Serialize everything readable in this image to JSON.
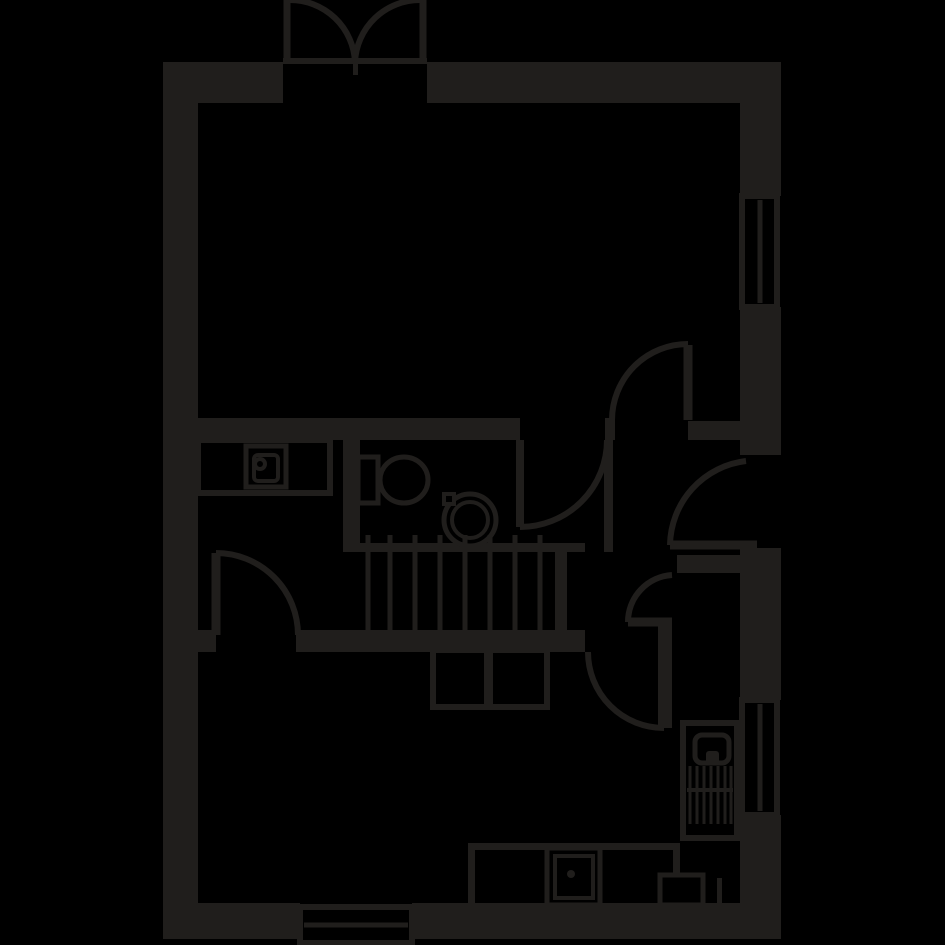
{
  "canvas": {
    "width": 945,
    "height": 945,
    "background": "#000000",
    "line_color": "#201E1C"
  },
  "plan": {
    "name": "house-ground-floor-plan",
    "strip": {
      "x": 163,
      "width": 618
    },
    "shapes": [
      {
        "name": "wall-left",
        "type": "rect",
        "x": 163,
        "y": 62,
        "w": 35,
        "h": 876
      },
      {
        "name": "wall-top-left",
        "type": "rect",
        "x": 163,
        "y": 62,
        "w": 120,
        "h": 41
      },
      {
        "name": "wall-top-right",
        "type": "rect",
        "x": 427,
        "y": 62,
        "w": 313,
        "h": 41
      },
      {
        "name": "wall-right-top",
        "type": "rect",
        "x": 740,
        "y": 62,
        "w": 41,
        "h": 134
      },
      {
        "name": "wall-right-mid",
        "type": "rect",
        "x": 740,
        "y": 307,
        "w": 41,
        "h": 148
      },
      {
        "name": "wall-right-lower",
        "type": "rect",
        "x": 740,
        "y": 548,
        "w": 41,
        "h": 152
      },
      {
        "name": "wall-right-bottom",
        "type": "rect",
        "x": 740,
        "y": 815,
        "w": 41,
        "h": 123
      },
      {
        "name": "wall-bottom-left",
        "type": "rect",
        "x": 163,
        "y": 903,
        "w": 137,
        "h": 36
      },
      {
        "name": "wall-bottom-right",
        "type": "rect",
        "x": 412,
        "y": 903,
        "w": 369,
        "h": 36
      },
      {
        "name": "wall-middle-left",
        "type": "rect",
        "x": 163,
        "y": 418,
        "w": 357,
        "h": 22
      },
      {
        "name": "wall-middle-jamb",
        "type": "rect",
        "x": 605,
        "y": 418,
        "w": 10,
        "h": 22
      },
      {
        "name": "wall-middle-right",
        "type": "rect",
        "x": 688,
        "y": 421,
        "w": 52,
        "h": 19
      },
      {
        "name": "wall-kitchen-wc",
        "type": "rect",
        "x": 343,
        "y": 418,
        "w": 17,
        "h": 134
      },
      {
        "name": "wall-wc-hall-stub",
        "type": "rect",
        "x": 604,
        "y": 440,
        "w": 9,
        "h": 112
      },
      {
        "name": "wall-stairs-top",
        "type": "rect",
        "x": 357,
        "y": 543,
        "w": 228,
        "h": 9
      },
      {
        "name": "stairs-right-edge",
        "type": "rect",
        "x": 555,
        "y": 543,
        "w": 12,
        "h": 90
      },
      {
        "name": "wall-under-stairs",
        "type": "rect",
        "x": 296,
        "y": 630,
        "w": 289,
        "h": 22
      },
      {
        "name": "wall-left-pier",
        "type": "rect",
        "x": 163,
        "y": 630,
        "w": 53,
        "h": 22
      },
      {
        "name": "wall-hall-southeast",
        "type": "rect",
        "x": 677,
        "y": 555,
        "w": 63,
        "h": 18
      },
      {
        "name": "wall-cupboard-bar",
        "type": "rect",
        "x": 658,
        "y": 622,
        "w": 14,
        "h": 106
      },
      {
        "name": "french-door-threshold",
        "type": "rect",
        "x": 283,
        "y": 58,
        "w": 144,
        "h": 6
      },
      {
        "name": "french-door-center-tick",
        "type": "rect",
        "x": 353,
        "y": 58,
        "w": 5,
        "h": 17
      },
      {
        "name": "window-right-top",
        "type": "orect",
        "x": 742,
        "y": 196,
        "w": 35,
        "h": 111,
        "sw": 6
      },
      {
        "name": "window-right-top-mullion",
        "type": "line",
        "x1": 760,
        "y1": 200,
        "x2": 760,
        "y2": 303,
        "sw": 5
      },
      {
        "name": "window-right-bottom",
        "type": "orect",
        "x": 742,
        "y": 700,
        "w": 35,
        "h": 115,
        "sw": 6
      },
      {
        "name": "window-right-bottom-mullion",
        "type": "line",
        "x1": 760,
        "y1": 704,
        "x2": 760,
        "y2": 811,
        "sw": 5
      },
      {
        "name": "window-bottom",
        "type": "orect",
        "x": 300,
        "y": 907,
        "w": 112,
        "h": 36,
        "sw": 6
      },
      {
        "name": "window-bottom-mullion",
        "type": "line",
        "x1": 304,
        "y1": 925,
        "x2": 408,
        "y2": 925,
        "sw": 5
      },
      {
        "name": "french-door-left-leaf",
        "type": "line",
        "x1": 287,
        "y1": 0,
        "x2": 287,
        "y2": 62,
        "sw": 7
      },
      {
        "name": "french-door-left-swing",
        "type": "path",
        "d": "M 355 62 A 65 65 0 0 0 290 0",
        "sw": 6
      },
      {
        "name": "french-door-right-leaf",
        "type": "line",
        "x1": 423,
        "y1": 0,
        "x2": 423,
        "y2": 62,
        "sw": 7
      },
      {
        "name": "french-door-right-swing",
        "type": "path",
        "d": "M 355 62 A 65 65 0 0 1 420 0",
        "sw": 6
      },
      {
        "name": "living-door-leaf",
        "type": "line",
        "x1": 688,
        "y1": 345,
        "x2": 688,
        "y2": 420,
        "sw": 9
      },
      {
        "name": "living-door-swing",
        "type": "path",
        "d": "M 612 420 A 76 76 0 0 1 688 344",
        "sw": 6
      },
      {
        "name": "wc-door-leaf",
        "type": "line",
        "x1": 520,
        "y1": 440,
        "x2": 520,
        "y2": 527,
        "sw": 8
      },
      {
        "name": "wc-door-swing",
        "type": "path",
        "d": "M 607 440 A 87 87 0 0 1 520 527",
        "sw": 6
      },
      {
        "name": "front-door-leaf",
        "type": "line",
        "x1": 670,
        "y1": 545,
        "x2": 757,
        "y2": 545,
        "sw": 9
      },
      {
        "name": "front-door-swing",
        "type": "path",
        "d": "M 746 461 A 86 86 0 0 0 670 545",
        "sw": 6
      },
      {
        "name": "dining-door-swing",
        "type": "path",
        "d": "M 588 652 A 76 76 0 0 0 664 728",
        "sw": 6
      },
      {
        "name": "kitchen-door-leaf",
        "type": "line",
        "x1": 216,
        "y1": 553,
        "x2": 216,
        "y2": 635,
        "sw": 9
      },
      {
        "name": "kitchen-door-swing",
        "type": "path",
        "d": "M 216 553 A 82 82 0 0 1 298 635",
        "sw": 6
      },
      {
        "name": "cupboard-door-leaf",
        "type": "line",
        "x1": 628,
        "y1": 622,
        "x2": 672,
        "y2": 622,
        "sw": 9
      },
      {
        "name": "cupboard-door-swing",
        "type": "path",
        "d": "M 672 575 A 47 47 0 0 0 628 622",
        "sw": 6
      },
      {
        "name": "kitchen-counter",
        "type": "orect",
        "x": 198,
        "y": 440,
        "w": 132,
        "h": 53,
        "sw": 6
      },
      {
        "name": "kitchen-sink",
        "type": "orect",
        "x": 246,
        "y": 446,
        "w": 40,
        "h": 41,
        "sw": 5
      },
      {
        "name": "kitchen-sink-bowl",
        "type": "orect",
        "x": 254,
        "y": 455,
        "w": 24,
        "h": 26,
        "sw": 4,
        "rx": 4
      },
      {
        "name": "kitchen-tap",
        "type": "circle",
        "cx": 260,
        "cy": 464,
        "r": 5,
        "sw": 4
      },
      {
        "name": "toilet-cistern",
        "type": "orect",
        "x": 358,
        "y": 457,
        "w": 20,
        "h": 46,
        "sw": 5
      },
      {
        "name": "toilet-bowl",
        "type": "ellipse",
        "cx": 404,
        "cy": 480,
        "rx": 24,
        "ry": 23,
        "sw": 5
      },
      {
        "name": "basin-outer",
        "type": "circle",
        "cx": 470,
        "cy": 520,
        "r": 26,
        "sw": 5
      },
      {
        "name": "basin-inner",
        "type": "circle",
        "cx": 470,
        "cy": 520,
        "r": 18,
        "sw": 4
      },
      {
        "name": "basin-tap",
        "type": "orect",
        "x": 444,
        "y": 494,
        "w": 10,
        "h": 10,
        "sw": 4
      },
      {
        "name": "stair-tread-1",
        "type": "line",
        "x1": 368,
        "y1": 535,
        "x2": 368,
        "y2": 630,
        "sw": 5
      },
      {
        "name": "stair-tread-2",
        "type": "line",
        "x1": 390,
        "y1": 535,
        "x2": 390,
        "y2": 630,
        "sw": 5
      },
      {
        "name": "stair-tread-3",
        "type": "line",
        "x1": 415,
        "y1": 535,
        "x2": 415,
        "y2": 630,
        "sw": 5
      },
      {
        "name": "stair-tread-4",
        "type": "line",
        "x1": 440,
        "y1": 535,
        "x2": 440,
        "y2": 630,
        "sw": 5
      },
      {
        "name": "stair-tread-5",
        "type": "line",
        "x1": 465,
        "y1": 535,
        "x2": 465,
        "y2": 630,
        "sw": 5
      },
      {
        "name": "stair-tread-6",
        "type": "line",
        "x1": 490,
        "y1": 535,
        "x2": 490,
        "y2": 630,
        "sw": 5
      },
      {
        "name": "stair-tread-7",
        "type": "line",
        "x1": 515,
        "y1": 535,
        "x2": 515,
        "y2": 630,
        "sw": 5
      },
      {
        "name": "stair-tread-8",
        "type": "line",
        "x1": 540,
        "y1": 535,
        "x2": 540,
        "y2": 630,
        "sw": 5
      },
      {
        "name": "understair-cupboard-1",
        "type": "orect",
        "x": 433,
        "y": 650,
        "w": 54,
        "h": 57,
        "sw": 6
      },
      {
        "name": "understair-cupboard-2",
        "type": "orect",
        "x": 490,
        "y": 650,
        "w": 57,
        "h": 57,
        "sw": 6
      },
      {
        "name": "larder-unit",
        "type": "orect",
        "x": 683,
        "y": 723,
        "w": 54,
        "h": 115,
        "sw": 6
      },
      {
        "name": "larder-window",
        "type": "orect",
        "x": 695,
        "y": 735,
        "w": 34,
        "h": 28,
        "sw": 5,
        "rx": 7
      },
      {
        "name": "larder-knob",
        "type": "frect",
        "x": 706,
        "y": 751,
        "w": 13,
        "h": 13,
        "rx": 3
      },
      {
        "name": "larder-grille-h",
        "type": "line",
        "x1": 687,
        "y1": 790,
        "x2": 733,
        "y2": 790,
        "sw": 4
      },
      {
        "name": "larder-grille-1",
        "type": "line",
        "x1": 690,
        "y1": 766,
        "x2": 690,
        "y2": 824,
        "sw": 3
      },
      {
        "name": "larder-grille-2",
        "type": "line",
        "x1": 697,
        "y1": 766,
        "x2": 697,
        "y2": 824,
        "sw": 3
      },
      {
        "name": "larder-grille-3",
        "type": "line",
        "x1": 704,
        "y1": 766,
        "x2": 704,
        "y2": 824,
        "sw": 3
      },
      {
        "name": "larder-grille-4",
        "type": "line",
        "x1": 711,
        "y1": 766,
        "x2": 711,
        "y2": 824,
        "sw": 3
      },
      {
        "name": "larder-grille-5",
        "type": "line",
        "x1": 718,
        "y1": 766,
        "x2": 718,
        "y2": 824,
        "sw": 3
      },
      {
        "name": "larder-grille-6",
        "type": "line",
        "x1": 725,
        "y1": 766,
        "x2": 725,
        "y2": 824,
        "sw": 3
      },
      {
        "name": "larder-grille-7",
        "type": "line",
        "x1": 731,
        "y1": 766,
        "x2": 731,
        "y2": 824,
        "sw": 3
      },
      {
        "name": "base-counter-top",
        "type": "frect",
        "x": 468,
        "y": 843,
        "w": 212,
        "h": 7
      },
      {
        "name": "base-counter-left",
        "type": "frect",
        "x": 468,
        "y": 843,
        "w": 7,
        "h": 62
      },
      {
        "name": "base-counter-right",
        "type": "frect",
        "x": 673,
        "y": 843,
        "w": 7,
        "h": 62
      },
      {
        "name": "appliance-oven",
        "type": "orect",
        "x": 547,
        "y": 848,
        "w": 53,
        "h": 57,
        "sw": 5
      },
      {
        "name": "appliance-oven-inner",
        "type": "orect",
        "x": 555,
        "y": 856,
        "w": 38,
        "h": 42,
        "sw": 4
      },
      {
        "name": "appliance-oven-dot",
        "type": "fcircle",
        "cx": 571,
        "cy": 874,
        "r": 4
      },
      {
        "name": "appliance-sink-unit",
        "type": "orect",
        "x": 660,
        "y": 875,
        "w": 43,
        "h": 30,
        "sw": 5
      },
      {
        "name": "counter-return-line",
        "type": "frect",
        "x": 717,
        "y": 878,
        "w": 5,
        "h": 27
      }
    ]
  }
}
